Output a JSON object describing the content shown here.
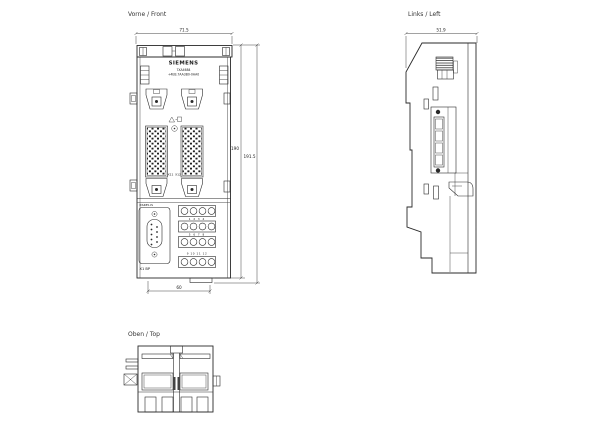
{
  "page": {
    "background": "#ffffff",
    "line_color": "#2a2a2a"
  },
  "front_view": {
    "label": "Vorne / Front",
    "brand": "SIEMENS",
    "part_line1": "7XA4684",
    "part_line2": "+4EB.7AA3B0-0AA0",
    "warning_icon": "⚠",
    "connector_left_label": "X11",
    "connector_right_label": "X12",
    "interface_label": "RS485-IS",
    "dsub_label": "X1 BP",
    "terminal_numbers_row2": "1 2 3 4",
    "terminal_numbers_row3": "5 6 7 8",
    "terminal_numbers_row4": "9 10 11 12",
    "dim_width": "71.5",
    "dim_height": "190",
    "dim_height_total": "191.5",
    "dim_width_bottom": "60"
  },
  "left_view": {
    "label": "Links / Left",
    "dim_width": "51.9"
  },
  "top_view": {
    "label": "Oben / Top"
  }
}
